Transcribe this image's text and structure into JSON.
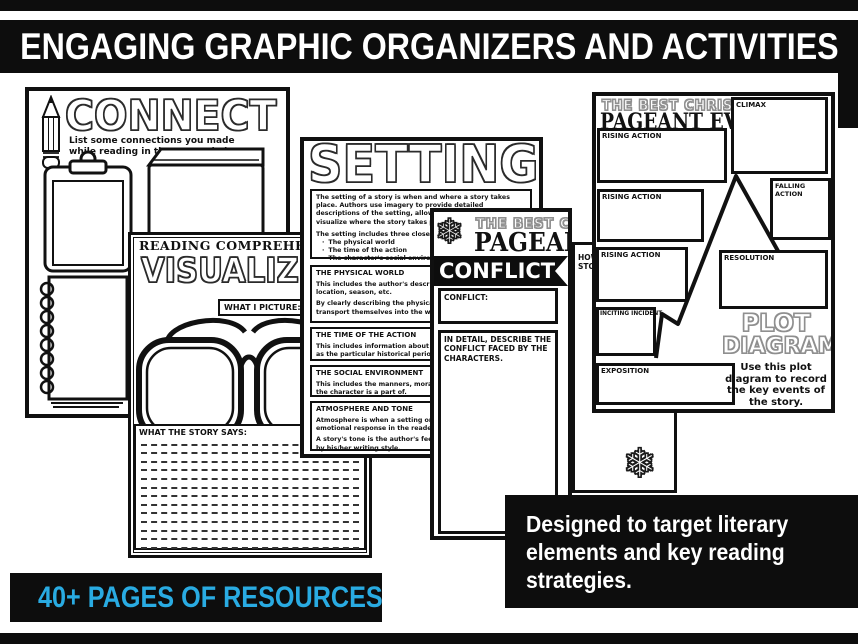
{
  "colors": {
    "accent": "#29abe2",
    "ink": "#111111",
    "banner_bg": "#0d0d0d",
    "paper": "#ffffff"
  },
  "icons": {
    "snowflake": "❄"
  },
  "header": {
    "title": "ENGAGING GRAPHIC ORGANIZERS AND ACTIVITIES"
  },
  "footer": {
    "pages_banner": "40+ PAGES OF RESOURCES"
  },
  "callout": {
    "lines": [
      "Designed to target literary",
      "elements and key reading",
      "strategies."
    ]
  },
  "connect": {
    "title": "CONNECT",
    "subtitle": "List some connections you made while reading in the spaces below."
  },
  "visualize": {
    "header": "READING COMPREHENSION STRATEGY",
    "title": "VISUALIZE",
    "picture_label": "WHAT I PICTURE:",
    "says_label": "WHAT THE STORY SAYS:"
  },
  "setting": {
    "title": "SETTING",
    "intro_p1": "The setting of a story is when and where a story takes place. Authors use imagery to provide detailed descriptions of the setting, allowing the reader to visualize where the story takes place.",
    "intro_p2": "The setting includes three closely related aspects:",
    "bullets": [
      "The physical world",
      "The time of the action",
      "The character's social environment"
    ],
    "sections": [
      {
        "heading": "THE PHYSICAL WORLD",
        "body1": "This includes the author's description of the scenery, location, season, etc.",
        "body2": "By clearly describing the physical world, readers can transport themselves into the world of the story."
      },
      {
        "heading": "THE TIME OF THE ACTION",
        "body1": "This includes information about the day and time as well as the particular historical period.",
        "body2": ""
      },
      {
        "heading": "THE SOCIAL ENVIRONMENT",
        "body1": "This includes the manners, moral values and customs that the character is a part of.",
        "body2": ""
      },
      {
        "heading": "ATMOSPHERE AND TONE",
        "body1": "Atmosphere is when a setting or scene creates an emotional response in the reader.",
        "body2": "A story's tone is the author's feelings and attitude shown by his/her writing style."
      }
    ]
  },
  "conflict": {
    "book_title_top": "THE BEST CHRISTMAS",
    "book_title_main": "PAGEANT EVER",
    "ribbon": "CONFLICT",
    "box1_label": "CONFLICT:",
    "box2_label": "IN DETAIL, DESCRIBE THE CONFLICT FACED BY THE CHARACTERS."
  },
  "peek": {
    "line1": "HOW I",
    "line2": "STORY"
  },
  "plot": {
    "book_title_top": "THE BEST CHRISTMAS",
    "book_title_main": "PAGEANT EVER",
    "title_line1": "PLOT",
    "title_line2": "DIAGRAM",
    "caption": "Use this plot diagram to record the key events of the story.",
    "boxes": {
      "rising1": "RISING ACTION",
      "climax": "CLIMAX",
      "rising2": "RISING ACTION",
      "falling": "FALLING ACTION",
      "rising3": "RISING ACTION",
      "resolution": "RESOLUTION",
      "inciting": "INCITING INCIDENT",
      "exposition": "EXPOSITION"
    }
  }
}
